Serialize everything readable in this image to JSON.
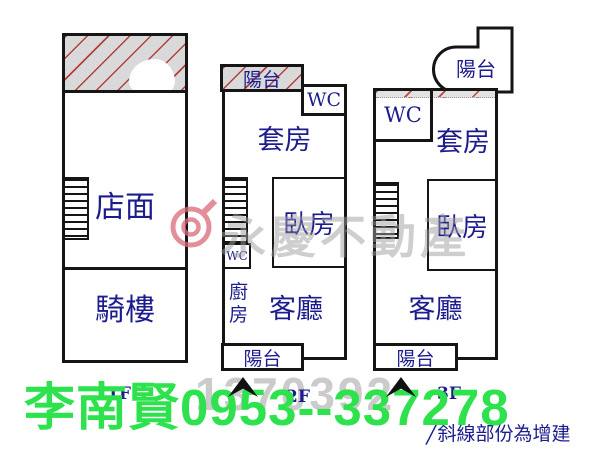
{
  "colors": {
    "navy": "#1c1c8e",
    "green": "#2ee24e",
    "wall": "#151515",
    "hatchgray": "#d9d9d9",
    "hatchred": "#b03636",
    "wmgray": "#9f9f9f",
    "numgray": "#cbcbcb",
    "logopink": "#d96a78"
  },
  "watermark": {
    "brand": "永慶不動產",
    "listing_number": "1370392"
  },
  "footer": {
    "agent_contact": "李南賢0953--337278",
    "note_mark": "╱",
    "note": "斜線部份為增建"
  },
  "plans": {
    "floor1": {
      "floor_label": "1F",
      "shop": "店面",
      "arcade": "騎樓"
    },
    "floor2": {
      "floor_label": "2F",
      "balcony_top": "陽台",
      "wc_upper": "WC",
      "suite": "套房",
      "bedroom": "臥房",
      "wc_lower": "WC",
      "kitchen": "廚房",
      "living_room": "客廳",
      "balcony_bottom": "陽台"
    },
    "floor3": {
      "floor_label": "3F",
      "balcony_top": "陽台",
      "wc": "WC",
      "suite": "套房",
      "bedroom": "臥房",
      "living_room": "客廳",
      "balcony_bottom": "陽台"
    }
  }
}
